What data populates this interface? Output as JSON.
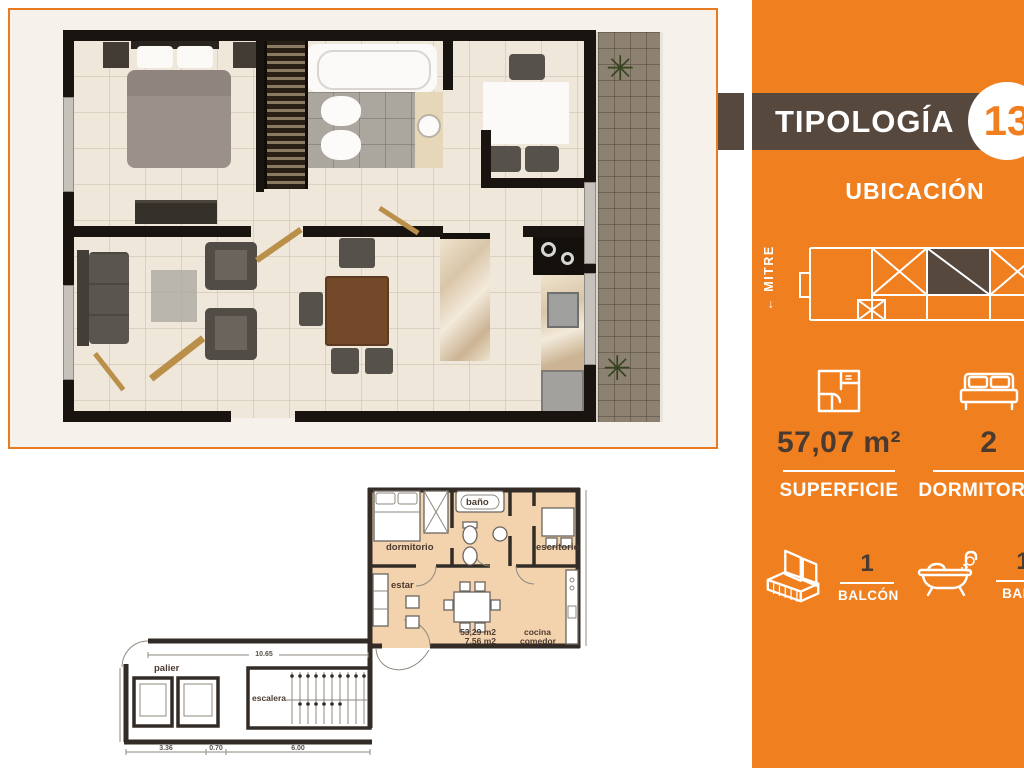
{
  "flyer": {
    "banner": {
      "title": "TIPOLOGÍA",
      "unit_number": "13"
    },
    "location": {
      "heading": "UBICACIÓN",
      "street": "← MITRE"
    },
    "stats": {
      "superficie": {
        "icon": "floorplan-icon",
        "value": "57,07 m²",
        "label": "SUPERFICIE"
      },
      "dormitorios": {
        "icon": "bed-icon",
        "value": "2",
        "label": "DORMITORIOS"
      },
      "balcon": {
        "icon": "balcony-icon",
        "value": "1",
        "label": "BALCÓN"
      },
      "bano": {
        "icon": "bathtub-icon",
        "value": "1",
        "label": "BAÑO"
      }
    },
    "colors": {
      "orange": "#F0801F",
      "banner_brown": "#57483E",
      "stat_value_brown": "#4A3A30",
      "frame_border_orange": "#E87A22",
      "plan2d_fill_peach": "#F3D2AE"
    }
  },
  "plan2d": {
    "rooms": {
      "dormitorio": "dormitorio",
      "bano": "baño",
      "escritorio": "escritorio",
      "estar": "estar",
      "cocina_line1": "cocina",
      "cocina_line2": "comedor"
    },
    "common": {
      "palier": "palier",
      "escalera": "escalera"
    },
    "areas": {
      "covered": "53,29 m2",
      "semi": "7,56 m2"
    },
    "dims": {
      "total": "10.65",
      "d1": "3.36",
      "d2": "0.70",
      "d3": "6.00"
    }
  }
}
